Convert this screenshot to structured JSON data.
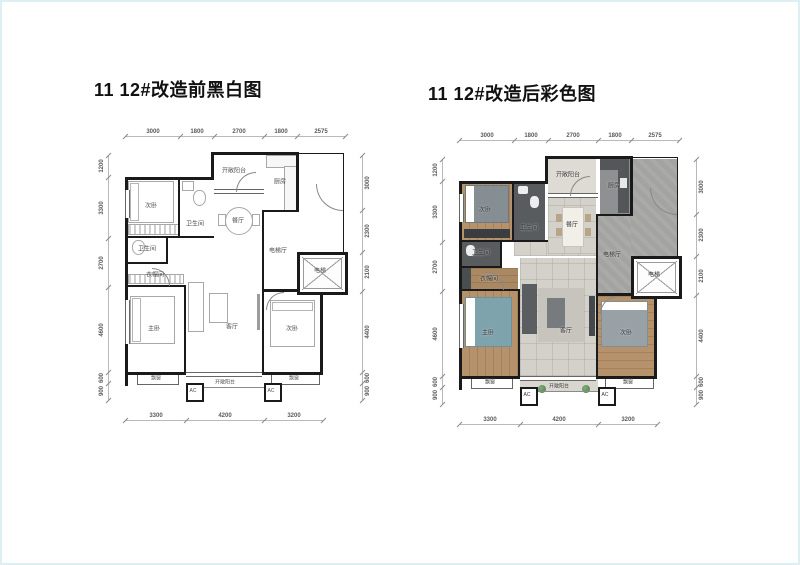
{
  "titles": {
    "before": "11 12#改造前黑白图",
    "after": "11 12#改造后彩色图"
  },
  "dims": {
    "top": [
      "3000",
      "1800",
      "2700",
      "1800",
      "2575"
    ],
    "bottom": [
      "3300",
      "4200",
      "3200"
    ],
    "left": [
      "1200",
      "3300",
      "2700",
      "4600",
      "600",
      "900"
    ],
    "right": [
      "3000",
      "2300",
      "2100",
      "4400",
      "600",
      "900"
    ]
  },
  "rooms": {
    "bedroom_top": "次卧",
    "bathroom_top": "卫生间",
    "bathroom_mid": "卫生间",
    "closet": "衣帽间",
    "master_bedroom": "主卧",
    "living_room": "客厅",
    "dining_room": "餐厅",
    "kitchen": "厨房",
    "balcony_top": "开敞阳台",
    "balcony_bottom": "开敞阳台",
    "elevator_hall": "电梯厅",
    "elevator": "电梯",
    "bedroom_right": "次卧",
    "bay_window_left": "飘窗",
    "bay_window_right": "飘窗",
    "ac_left": "AC",
    "ac_right": "AC"
  },
  "icons": {
    "elevator_cross": "x-cross",
    "door_arc": "quarter-circle-swing",
    "plant": "green-circle"
  },
  "colors": {
    "wall": "#1a1a1a",
    "wood_floor": "#b5916c",
    "tile_floor": "#d4d1cb",
    "bathroom_dark": "#585c5f",
    "stone_gray": "#a3a3a1",
    "bed_teal": "#7fa3ad",
    "plant_green": "#4c7a45",
    "dim_line": "#b9b9b9",
    "page_border": "#ddeff1"
  }
}
